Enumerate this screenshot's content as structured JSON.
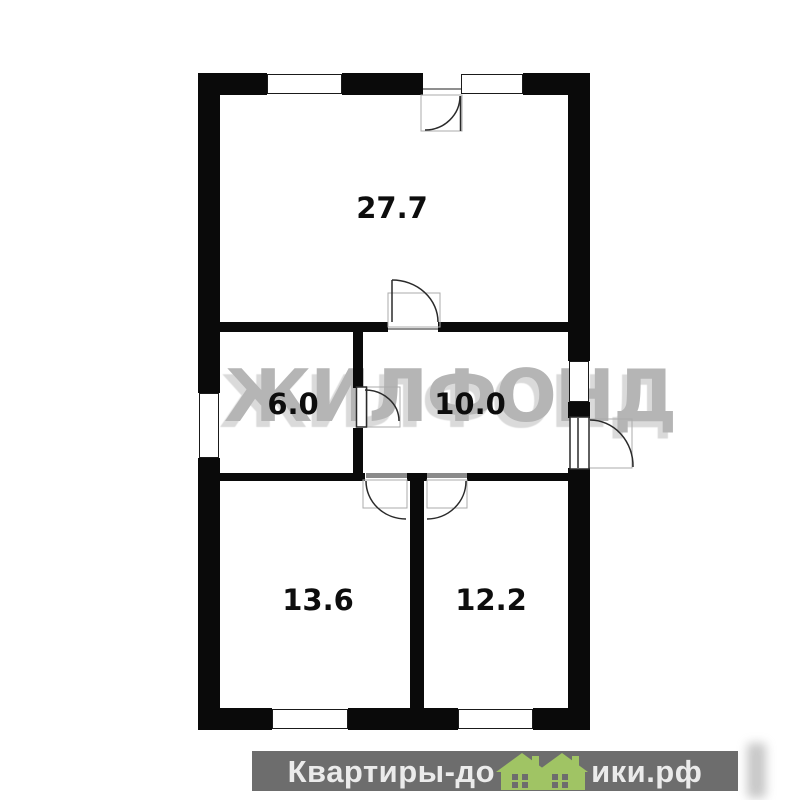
{
  "plan": {
    "watermark_text": "ЖИЛФОНД",
    "rooms": [
      {
        "name": "room-top",
        "area_label": "27.7"
      },
      {
        "name": "room-middle-left",
        "area_label": "6.0"
      },
      {
        "name": "room-middle-right",
        "area_label": "10.0"
      },
      {
        "name": "room-bottom-left",
        "area_label": "13.6"
      },
      {
        "name": "room-bottom-right",
        "area_label": "12.2"
      }
    ]
  },
  "footer": {
    "text_before_icon": "Квартиры-до",
    "text_after_icon": "ики.рф",
    "full_site_name": "Квартиры-домики.рф",
    "houses_icon": "houses-icon"
  },
  "colors": {
    "wall": "#0a0a0a",
    "watermark_gray": "#b5b5b5",
    "footer_bar_gray": "#6d6d6d",
    "footer_text_gray": "#ebebeb",
    "house_green": "#a0c464",
    "door_line": "#2a2a2a",
    "door_frame_gray": "#ababab"
  }
}
